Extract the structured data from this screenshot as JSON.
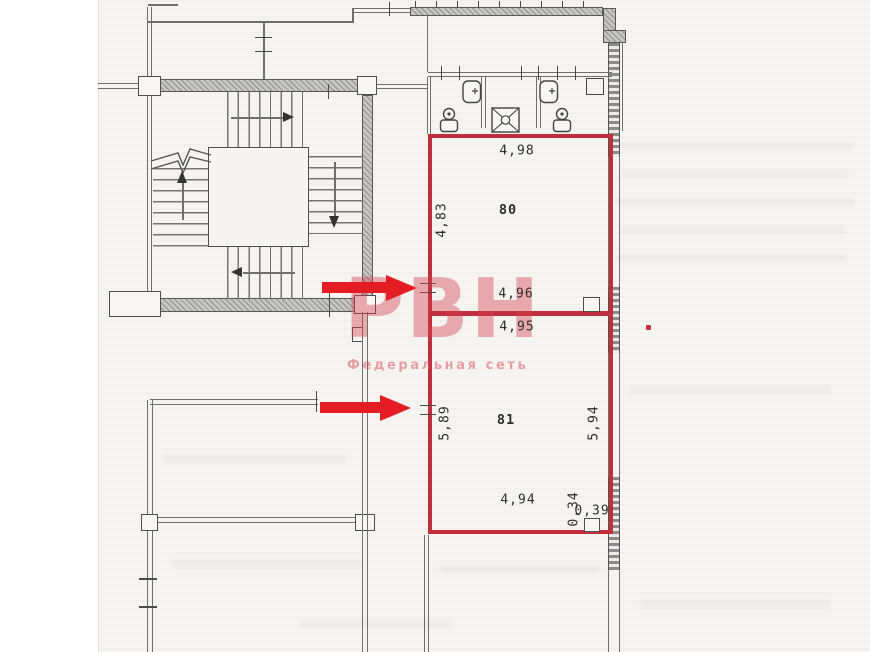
{
  "watermark": {
    "logo": "РВН",
    "subtitle": "Федеральная сеть"
  },
  "rooms": {
    "r80": {
      "number": "80",
      "dim_top": "4,98",
      "dim_left": "4,83",
      "dim_bottom": "4,96"
    },
    "r81": {
      "number": "81",
      "dim_top": "4,95",
      "dim_left": "5,89",
      "dim_right": "5,94",
      "dim_bottom": "4,94",
      "dim_column_depth": "0,34",
      "dim_column_width": "0,39"
    }
  },
  "colors": {
    "outline_red": "#c22f3c",
    "arrow_red": "#e41d24",
    "watermark_pink": "rgba(213,64,78,0.42)",
    "wall_gray": "#6f6f6f"
  }
}
